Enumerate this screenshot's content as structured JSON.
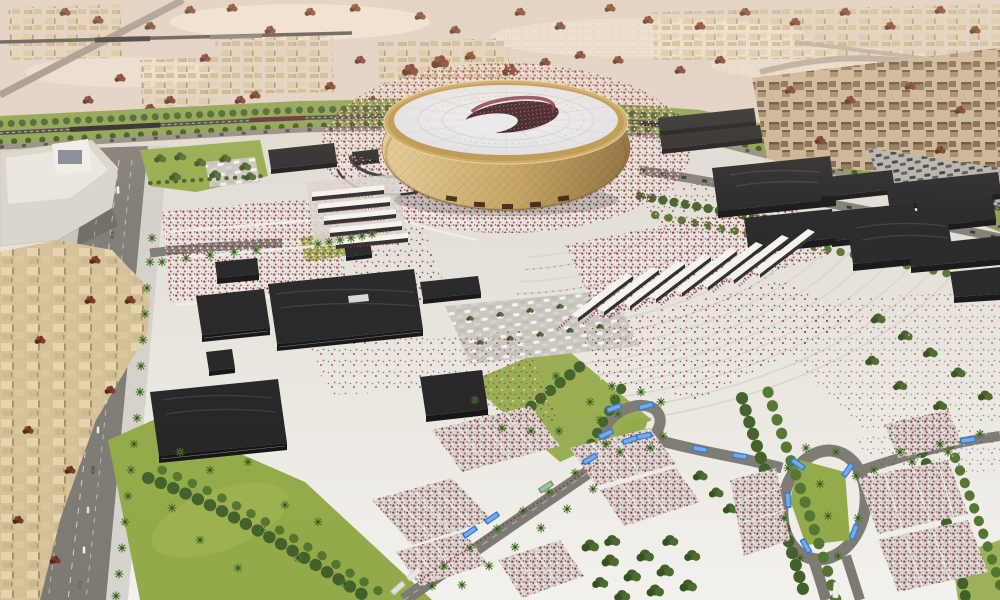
{
  "scene": {
    "title": "Aerial rendering of a golden stadium precinct in a desert city",
    "landmark": "golden bowl stadium with white ribbed roof and dark crescent opening",
    "surroundings": [
      "fan plaza with maroon-and-white crowds",
      "black flat-roofed pavilions",
      "white entry gate canopies",
      "palm-lined boulevard",
      "residential blocks",
      "rail and green corridor",
      "desert villages and red shrubs",
      "queue pens",
      "bus loops with blue buses",
      "lawns and tree rows",
      "concentric arc paving"
    ]
  },
  "palette": {
    "desert_far": "#dccfc3",
    "desert_near": "#eee2d8",
    "sand_patch": "#f4eadd",
    "corridor_green": "#87a04a",
    "lawn_green": "#92aa49",
    "lawn_light": "#a4b858",
    "tree_dark": "#41602a",
    "tree_light": "#547531",
    "palm_green": "#44702a",
    "road_gray": "#7d7a74",
    "rail_dark": "#3d3d3b",
    "plaza_top": "#dedbd4",
    "plaza_bottom": "#f3f1ec",
    "arc_line": "#d9d5ce",
    "pavilion_black": "#232325",
    "pavilion_front": "#121214",
    "stadium_gold_light": "#e4cb92",
    "stadium_gold": "#c2a05e",
    "stadium_gold_dark": "#8a6a36",
    "stadium_rim": "#c9a55c",
    "roof_white": "#f1f2f5",
    "roof_edge": "#dee0e4",
    "roof_rib": "#d3d5da",
    "bowl_dark": "#2d1016",
    "bowl_seats": "#7c2532",
    "crowd_maroon": "#8c2433",
    "crowd_white": "#f4f1ea",
    "crowd_dark": "#47474a",
    "bus_blue": "#2e7cd6",
    "bus_green": "#6f9d64",
    "bus_white": "#e9e7e2",
    "village_beige": "#d8c5a0",
    "district_brown": "#8c7356",
    "residential_beige": "#d3c096",
    "shrub_red": "#5f2a1a",
    "station_white": "#e9e7e1"
  },
  "counts": {
    "entry_gates_east": 8,
    "entry_gates_west": 5,
    "black_pavilions": 21,
    "buses": 20,
    "bus_loops": 2,
    "queue_pens": 10
  }
}
